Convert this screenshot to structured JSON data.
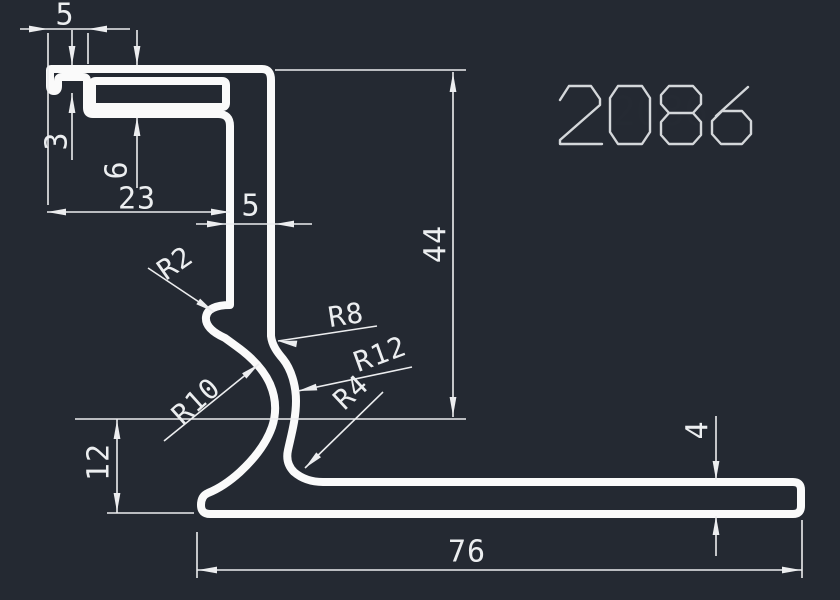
{
  "drawing": {
    "part_number": "2086",
    "background_color": "#242932",
    "line_color": "#fafafa",
    "dimensions": {
      "top_lip_width": "5",
      "lip_depth": "3",
      "step_depth": "6",
      "top_offset": "23",
      "wall_thickness": "5",
      "overall_height": "44",
      "foot_height": "12",
      "base_thickness": "4",
      "base_width": "76"
    },
    "radii": {
      "r2": "R2",
      "r8": "R8",
      "r12": "R12",
      "r10": "R10",
      "r4": "R4"
    }
  }
}
